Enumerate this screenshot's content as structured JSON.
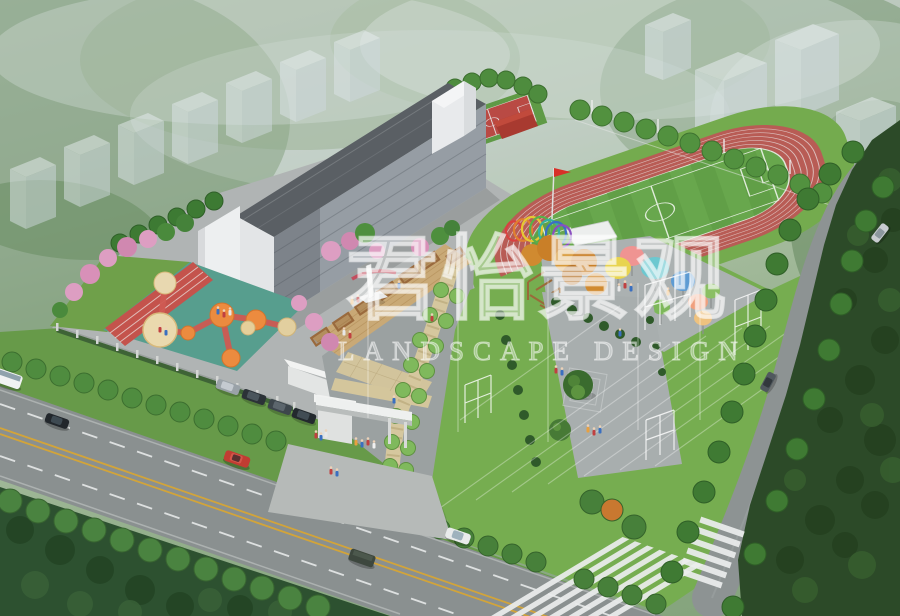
{
  "meta": {
    "image_type": "aerial 3D landscape-design rendering",
    "subject": "school campus master plan with running track, teaching building, playground, entrance plaza and surrounding roads"
  },
  "watermark": {
    "brand_cn": "君怡景观",
    "brand_en": "LANDSCAPE DESIGN"
  },
  "scene": {
    "elements": [
      "foggy forest background",
      "ghosted residential towers",
      "teaching building",
      "running track with soccer field",
      "red flag",
      "basketball court",
      "children playground with colored circles",
      "wooden deck plaza with sculpture",
      "rainbow arches",
      "colorful round canopies",
      "central lawn with tree plaza",
      "white trellis frames",
      "tree-lined walkway",
      "entrance gate with people",
      "parked cars",
      "main road with crosswalks",
      "curved side road",
      "street trees"
    ]
  },
  "palette": {
    "fog_sky": "#ccd6d2",
    "forest_dark": "#2c4a28",
    "street_tree_green": "#4f8c3f",
    "lawn_green": "#76ad50",
    "field_green": "#68a74d",
    "track_red": "#b85c55",
    "court_red": "#b94a44",
    "road_gray": "#8a9090",
    "plaza_gray": "#a8aeae",
    "building_facade": "#969da4",
    "roof_dark": "#5a5f64",
    "deck_wood": "#c9a976",
    "playground_teal": "#579e8e",
    "playground_orange": "#ec8b3f",
    "canopy_colors": [
      "#ef9492",
      "#e8d44f",
      "#6cc8d0",
      "#5d9bd3",
      "#8abf63",
      "#f0a07e",
      "#7db85a",
      "#eec27f"
    ],
    "arch_colors": [
      "#d94040",
      "#e08030",
      "#e6c832",
      "#58b04a",
      "#35b0a0",
      "#3a6fc4",
      "#8a4fc0"
    ],
    "road_marking_yellow": "#d2a43a",
    "watermark_white": "rgba(255,255,255,0.5)"
  }
}
